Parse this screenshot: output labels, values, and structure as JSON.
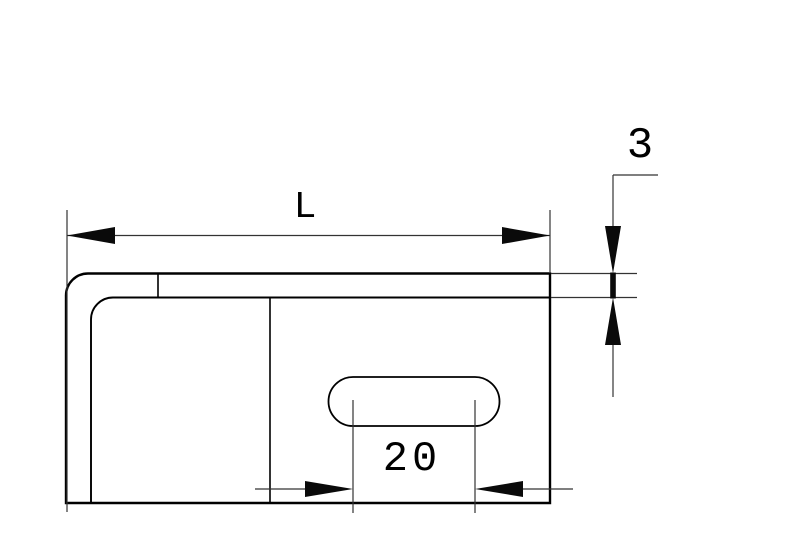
{
  "drawing": {
    "kind": "technical-dimension-drawing",
    "subject": "L-shaped sheet-metal bracket side view with slotted hole",
    "background_color": "#ffffff",
    "outline_color": "#000000",
    "dimension_line_color": "#333333",
    "dimensions": {
      "length_label": "L",
      "thickness_label": "3",
      "slot_label": "20"
    }
  }
}
